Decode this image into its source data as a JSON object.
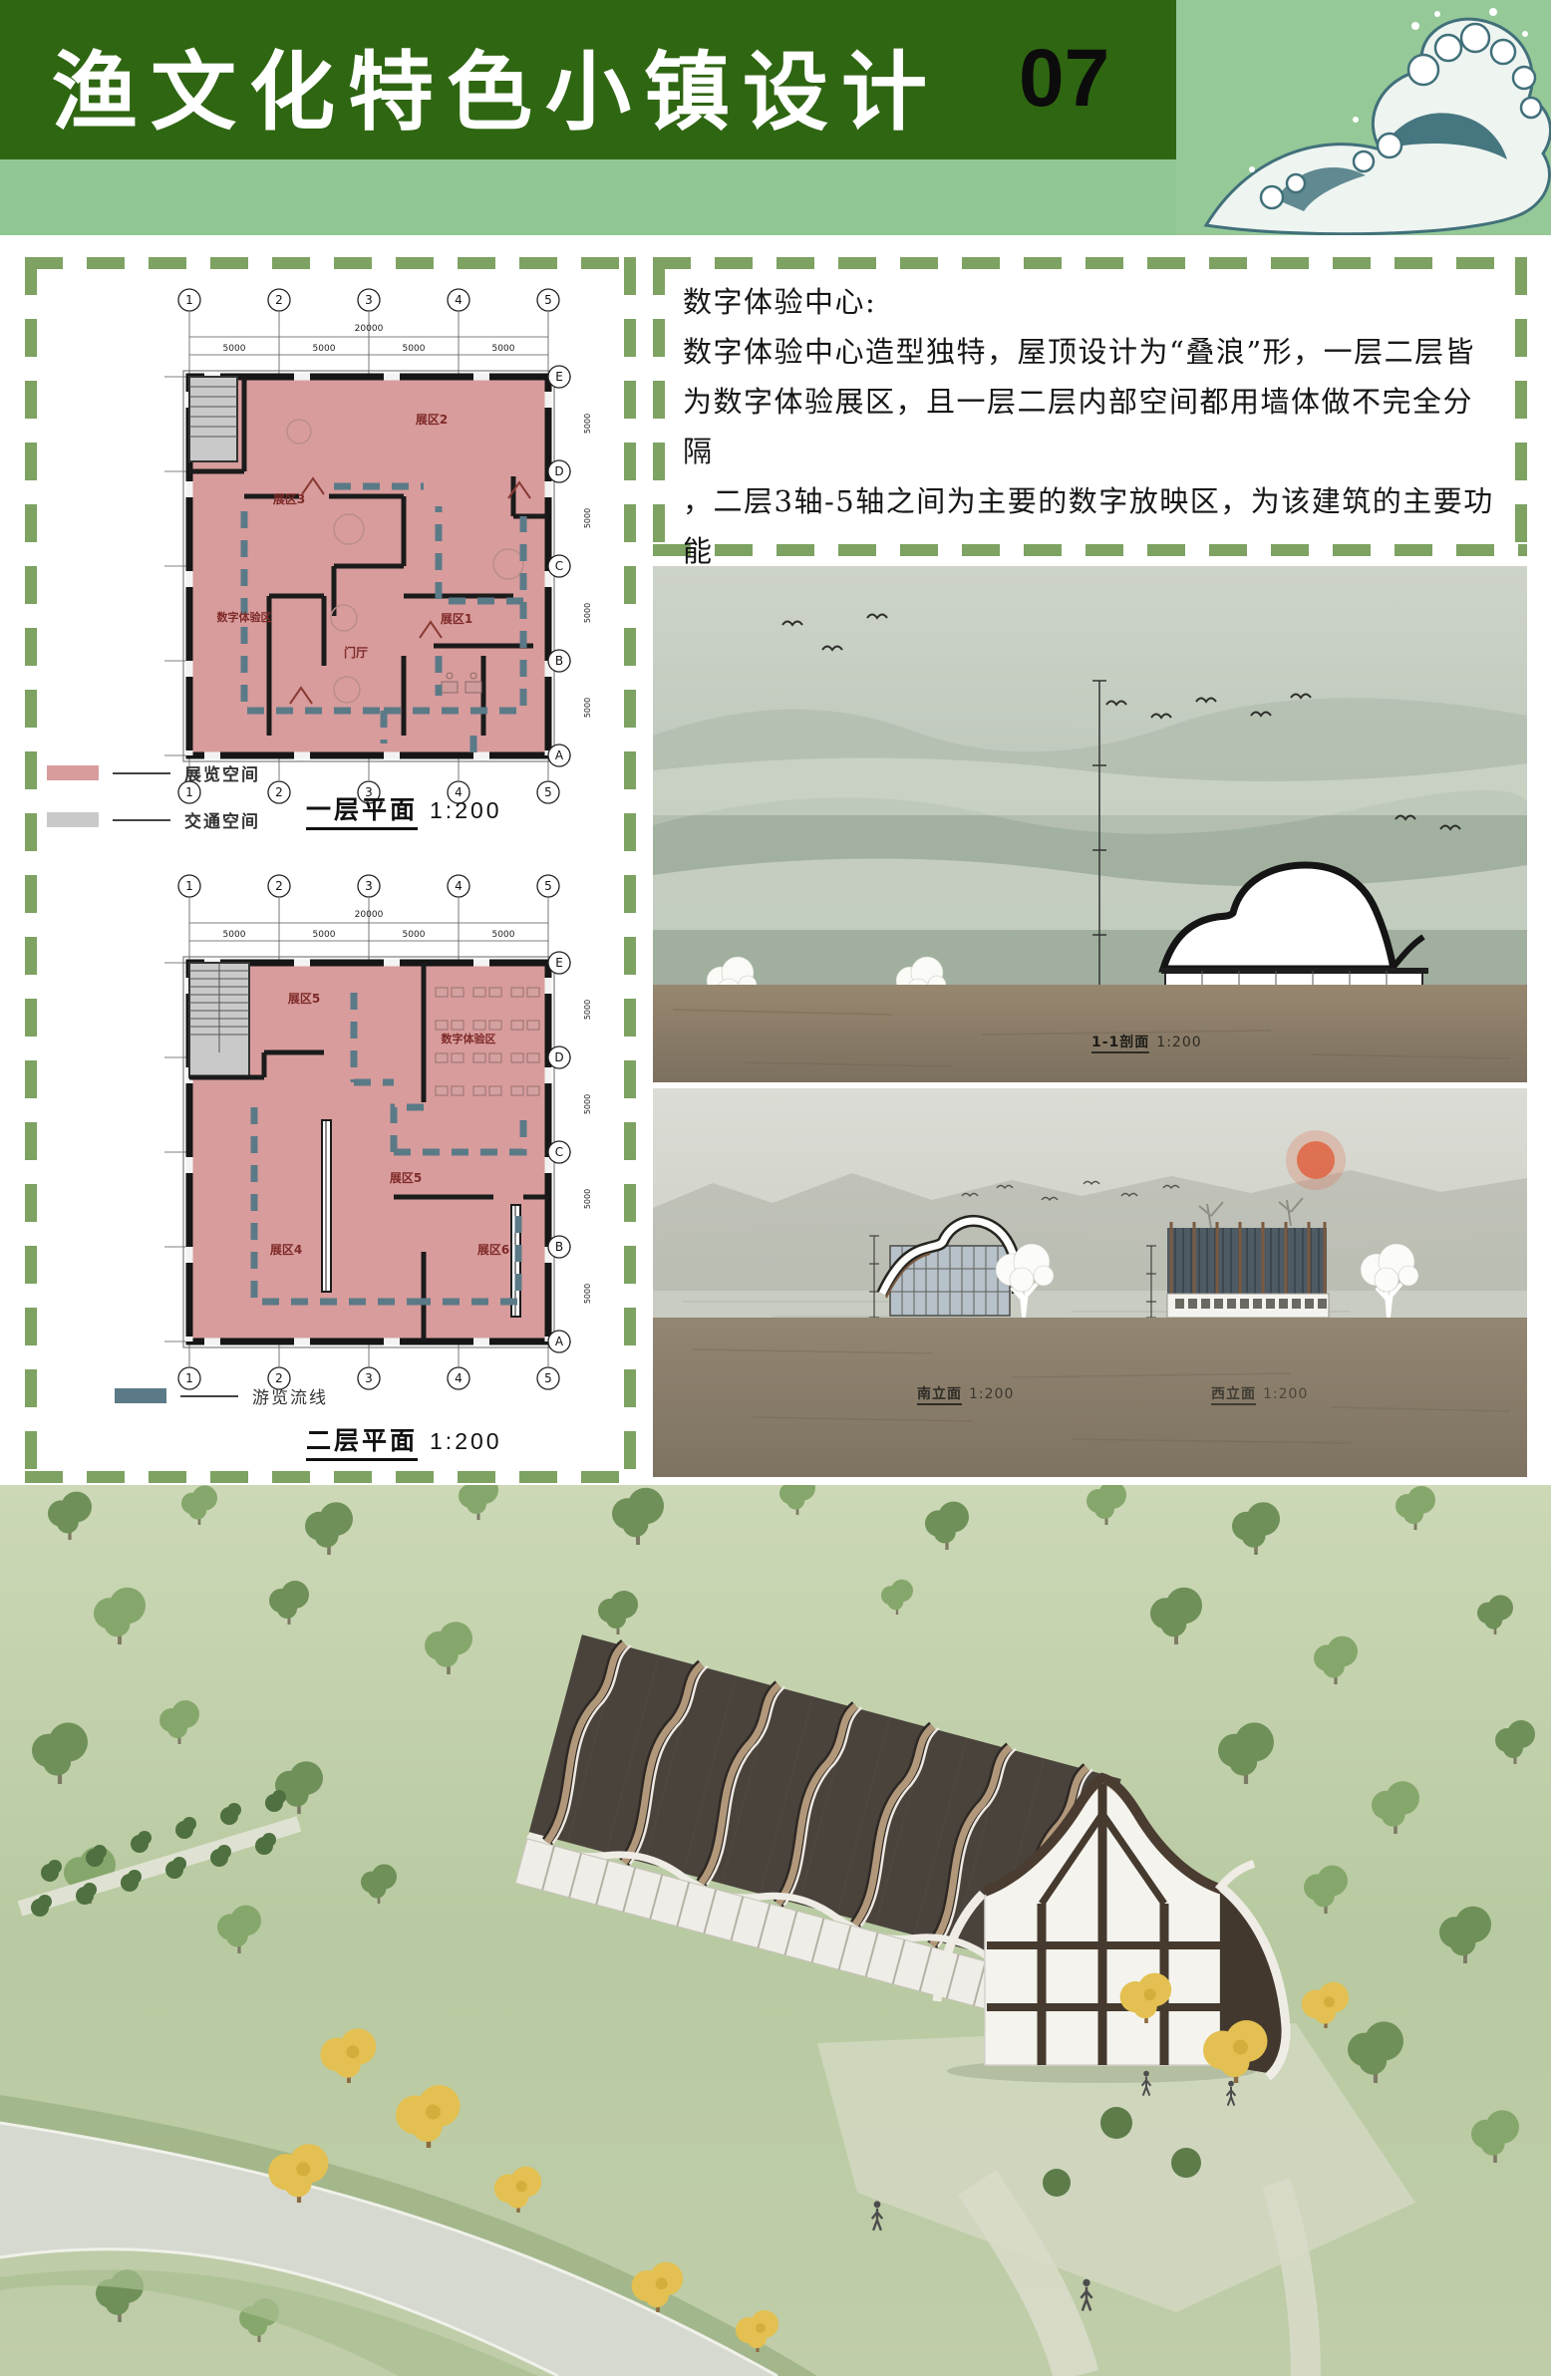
{
  "header": {
    "title": "渔文化特色小镇设计",
    "page_number": "07"
  },
  "intro": {
    "heading": "数字体验中心:",
    "line1": "数字体验中心造型独特，屋顶设计为“叠浪”形，一层二层皆",
    "line2": "为数字体验展区，且一层二层内部空间都用墙体做不完全分隔",
    "line3": "，二层3轴-5轴之间为主要的数字放映区，为该建筑的主要功能",
    "line4": "空间"
  },
  "plans": {
    "grid": {
      "numbers": [
        "1",
        "2",
        "3",
        "4",
        "5"
      ],
      "letters": [
        "E",
        "D",
        "C",
        "B",
        "A"
      ],
      "bay": "5000",
      "total": "20000"
    },
    "floor1": {
      "title": "一层平面",
      "scale": "1:200",
      "legend": [
        {
          "label": "展览空间",
          "color": "#d89c9c"
        },
        {
          "label": "交通空间",
          "color": "#c9c9c9"
        }
      ],
      "rooms": {
        "r2": "展区2",
        "r3": "展区3",
        "digital": "数字体验区",
        "lobby": "门厅",
        "r1": "展区1"
      }
    },
    "floor2": {
      "title": "二层平面",
      "scale": "1:200",
      "legend": [
        {
          "label": "游览流线",
          "color": "#5b7a87"
        }
      ],
      "rooms": {
        "r5a": "展区5",
        "digital": "数字体验区",
        "r5b": "展区5",
        "r4": "展区4",
        "r6": "展区6"
      }
    }
  },
  "elevations": {
    "section": {
      "label": "1-1剖面",
      "scale": "1:200"
    },
    "south": {
      "label": "南立面",
      "scale": "1:200"
    },
    "west": {
      "label": "西立面",
      "scale": "1:200"
    }
  },
  "colors": {
    "header_green": "#2f6612",
    "strip_green": "#8fc795",
    "dash_green": "#7da262",
    "plan_pink": "#d89c9c",
    "circulation_gray": "#c9c9c9",
    "route_teal": "#5b7a87",
    "sun_red": "#df6847"
  }
}
